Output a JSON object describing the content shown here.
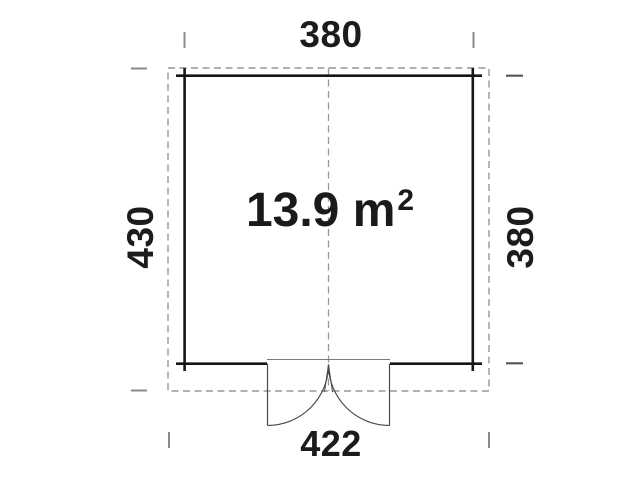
{
  "floor_plan": {
    "area_value": "13.9 m",
    "area_exponent": "2",
    "dimensions": {
      "top": "380",
      "right": "380",
      "bottom": "422",
      "left": "430"
    },
    "colors": {
      "wall": "#161616",
      "dashed_outline": "#979797",
      "door_lines": "#4a4a4a",
      "tick": "#8a8a8a",
      "text": "#1c1c1c",
      "background": "#ffffff"
    }
  }
}
